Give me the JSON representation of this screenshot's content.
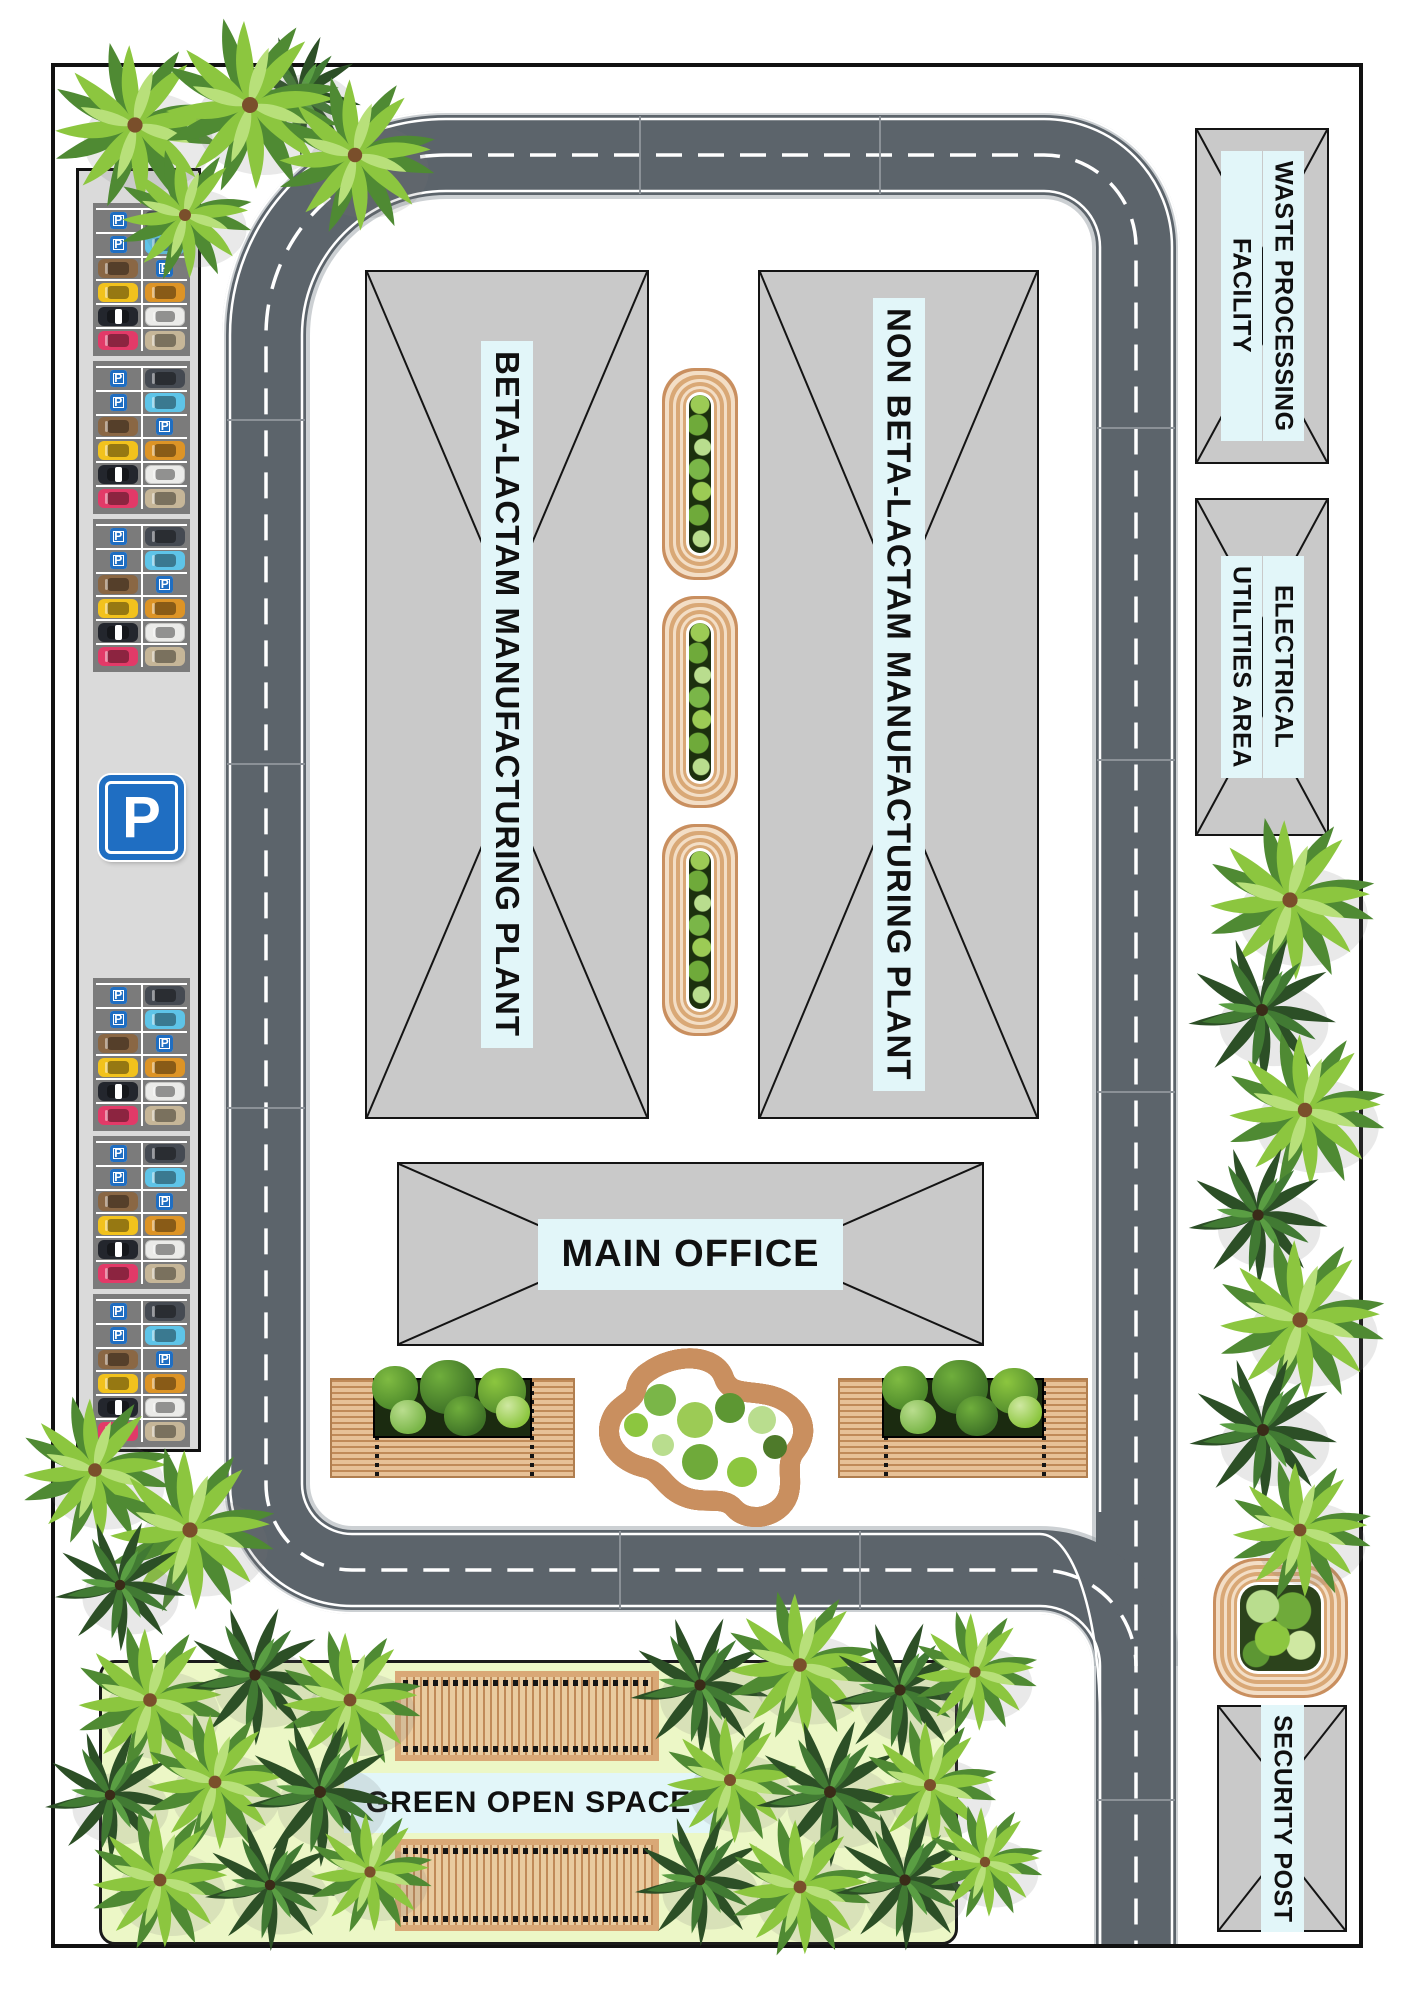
{
  "labels": {
    "beta_plant": "BETA-LACTAM MANUFACTURING PLANT",
    "non_beta_plant": "NON BETA-LACTAM MANUFACTURING PLANT",
    "main_office": "MAIN OFFICE",
    "green_open_space": "GREEN OPEN SPACE",
    "waste_line1": "WASTE PROCESSING",
    "waste_line2": "FACILITY",
    "electrical_line1": "ELECTRICAL",
    "electrical_line2": "UTILITIES AREA",
    "security_post": "SECURITY POST"
  },
  "parking": {
    "sign_letter": "P",
    "block_count": 6,
    "stall_pattern": [
      [
        "sign",
        "car:black"
      ],
      [
        "sign",
        "car:cyan"
      ],
      [
        "car:brown",
        "sign"
      ],
      [
        "car:taxi",
        "car:orange"
      ],
      [
        "car:police",
        "car:white"
      ],
      [
        "car:pink",
        "car:van"
      ]
    ]
  },
  "planters": {
    "capsule_planters": 3,
    "deck_planters": 2,
    "square_planters": 1,
    "garden_blob": 1,
    "lawn_decks": 2
  },
  "colors": {
    "road": "#5c646b",
    "building_fill": "#c9c9c9",
    "building_line": "#141414",
    "label_background": "#e2f6f9",
    "wood": "#d9a876",
    "wood_light": "#f3dec6",
    "lawn": "#ecf7c6",
    "parking_sign_blue": "#1f6ec2",
    "parking_strip": "#dadada",
    "parking_block": "#7b7b7b"
  }
}
